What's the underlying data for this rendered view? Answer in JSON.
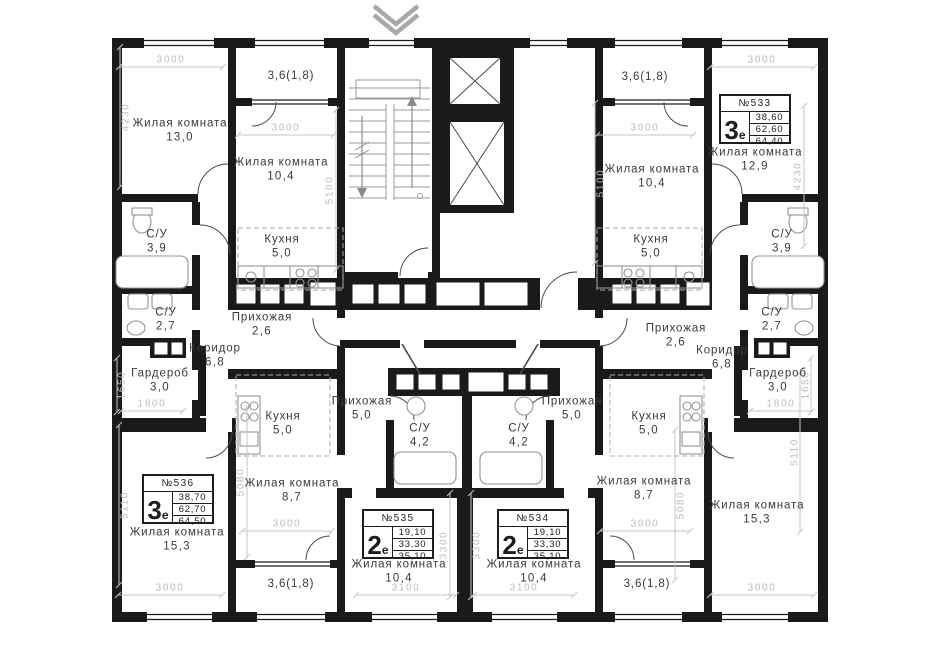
{
  "palette": {
    "wall": "#1a1a1a",
    "background": "#ffffff",
    "dimension_text": "#bcbcbc",
    "label_text": "#3a3a3a",
    "fixture": "#949494",
    "chevron": "#a8a8a8"
  },
  "icons": {
    "entrance_chevron": "double chevron pointing down at building entrance"
  },
  "rooms": [
    {
      "name": "Жилая комната",
      "area": "13,0",
      "x": 180,
      "y": 131
    },
    {
      "name": "Жилая комната",
      "area": "10,4",
      "x": 281,
      "y": 170
    },
    {
      "name": "Кухня",
      "area": "5,0",
      "x": 282,
      "y": 247
    },
    {
      "name": "С/У",
      "area": "3,9",
      "x": 157,
      "y": 242
    },
    {
      "name": "С/У",
      "area": "2,7",
      "x": 166,
      "y": 320
    },
    {
      "name": "Коридор",
      "area": "6,8",
      "x": 215,
      "y": 356
    },
    {
      "name": "Гардероб",
      "area": "3,0",
      "x": 160,
      "y": 381
    },
    {
      "name": "Прихожая",
      "area": "2,6",
      "x": 262,
      "y": 325
    },
    {
      "name": "Жилая комната",
      "area": "15,3",
      "x": 177,
      "y": 540
    },
    {
      "name": "Кухня",
      "area": "5,0",
      "x": 283,
      "y": 424
    },
    {
      "name": "Прихожая",
      "area": "5,0",
      "x": 362,
      "y": 409
    },
    {
      "name": "С/У",
      "area": "4,2",
      "x": 420,
      "y": 436
    },
    {
      "name": "Жилая комната",
      "area": "8,7",
      "x": 292,
      "y": 491
    },
    {
      "name": "Жилая комната",
      "area": "10,4",
      "x": 399,
      "y": 572
    },
    {
      "name": "Кухня",
      "area": "5,0",
      "x": 649,
      "y": 424
    },
    {
      "name": "Прихожая",
      "area": "5,0",
      "x": 572,
      "y": 409
    },
    {
      "name": "С/У",
      "area": "4,2",
      "x": 519,
      "y": 436
    },
    {
      "name": "Жилая комната",
      "area": "8,7",
      "x": 644,
      "y": 489
    },
    {
      "name": "Жилая комната",
      "area": "10,4",
      "x": 534,
      "y": 572
    },
    {
      "name": "Жилая комната",
      "area": "12,9",
      "x": 755,
      "y": 160
    },
    {
      "name": "Жилая комната",
      "area": "10,4",
      "x": 652,
      "y": 177
    },
    {
      "name": "Кухня",
      "area": "5,0",
      "x": 651,
      "y": 247
    },
    {
      "name": "С/У",
      "area": "3,9",
      "x": 782,
      "y": 242
    },
    {
      "name": "С/У",
      "area": "2,7",
      "x": 772,
      "y": 320
    },
    {
      "name": "Коридор",
      "area": "6,8",
      "x": 722,
      "y": 358
    },
    {
      "name": "Гардероб",
      "area": "3,0",
      "x": 778,
      "y": 381
    },
    {
      "name": "Прихожая",
      "area": "2,6",
      "x": 676,
      "y": 336
    },
    {
      "name": "Жилая комната",
      "area": "15,3",
      "x": 757,
      "y": 513
    }
  ],
  "balcony_labels": [
    {
      "text": "3,6(1,8)",
      "x": 291,
      "y": 76
    },
    {
      "text": "3,6(1,8)",
      "x": 645,
      "y": 77
    },
    {
      "text": "3,6(1,8)",
      "x": 291,
      "y": 584
    },
    {
      "text": "3,6(1,8)",
      "x": 647,
      "y": 584
    }
  ],
  "dimensions": [
    {
      "t": "3000",
      "x": 171,
      "y": 60,
      "o": "h",
      "len": 104
    },
    {
      "t": "4230",
      "x": 126,
      "y": 117,
      "o": "v",
      "len": 140,
      "lo": -6
    },
    {
      "t": "3000",
      "x": 286,
      "y": 128,
      "o": "h",
      "len": 96
    },
    {
      "t": "5100",
      "x": 330,
      "y": 190,
      "o": "v",
      "len": 160,
      "lo": 6
    },
    {
      "t": "1650",
      "x": 122,
      "y": 385,
      "o": "v",
      "len": 54,
      "lo": -5
    },
    {
      "t": "1800",
      "x": 152,
      "y": 404,
      "o": "h",
      "len": 62
    },
    {
      "t": "5110",
      "x": 125,
      "y": 505,
      "o": "v",
      "len": 160,
      "lo": -6
    },
    {
      "t": "3000",
      "x": 170,
      "y": 588,
      "o": "h",
      "len": 104
    },
    {
      "t": "5080",
      "x": 241,
      "y": 482,
      "o": "v",
      "len": 150,
      "lo": 6
    },
    {
      "t": "3000",
      "x": 287,
      "y": 524,
      "o": "h",
      "len": 90
    },
    {
      "t": "3100",
      "x": 406,
      "y": 588,
      "o": "h",
      "len": 100
    },
    {
      "t": "3300",
      "x": 444,
      "y": 545,
      "o": "v",
      "len": 104,
      "lo": 6
    },
    {
      "t": "3000",
      "x": 762,
      "y": 60,
      "o": "h",
      "len": 104
    },
    {
      "t": "4230",
      "x": 798,
      "y": 176,
      "o": "v",
      "len": 140,
      "lo": 6
    },
    {
      "t": "3000",
      "x": 645,
      "y": 128,
      "o": "h",
      "len": 96
    },
    {
      "t": "5100",
      "x": 601,
      "y": 183,
      "o": "v",
      "len": 160,
      "lo": -6
    },
    {
      "t": "1650",
      "x": 806,
      "y": 385,
      "o": "v",
      "len": 54,
      "lo": 5
    },
    {
      "t": "1800",
      "x": 781,
      "y": 404,
      "o": "h",
      "len": 62
    },
    {
      "t": "5110",
      "x": 795,
      "y": 452,
      "o": "v",
      "len": 160,
      "lo": 5
    },
    {
      "t": "3000",
      "x": 762,
      "y": 588,
      "o": "h",
      "len": 104
    },
    {
      "t": "5080",
      "x": 681,
      "y": 505,
      "o": "v",
      "len": 150,
      "lo": -6
    },
    {
      "t": "3000",
      "x": 645,
      "y": 524,
      "o": "h",
      "len": 90
    },
    {
      "t": "3100",
      "x": 524,
      "y": 588,
      "o": "h",
      "len": 100
    },
    {
      "t": "3300",
      "x": 477,
      "y": 545,
      "o": "v",
      "len": 104,
      "lo": -6
    }
  ],
  "apartments": [
    {
      "number": "№533",
      "type_digit": "3",
      "type_letter": "е",
      "areas": [
        "38,60",
        "62,60",
        "64,40"
      ],
      "x": 719,
      "y": 94
    },
    {
      "number": "№534",
      "type_digit": "2",
      "type_letter": "е",
      "areas": [
        "19,10",
        "33,30",
        "35,10"
      ],
      "x": 497,
      "y": 509
    },
    {
      "number": "№535",
      "type_digit": "2",
      "type_letter": "е",
      "areas": [
        "19,10",
        "33,30",
        "35,10"
      ],
      "x": 362,
      "y": 509
    },
    {
      "number": "№536",
      "type_digit": "3",
      "type_letter": "е",
      "areas": [
        "38,70",
        "62,70",
        "64,50"
      ],
      "x": 142,
      "y": 474
    }
  ]
}
